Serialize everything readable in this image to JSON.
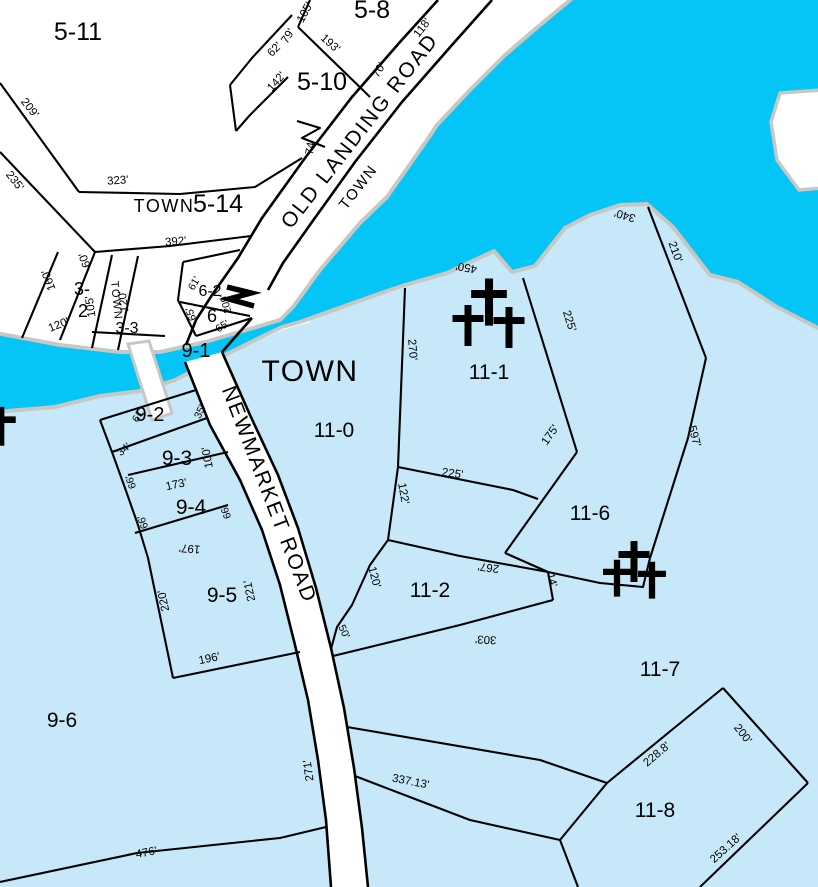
{
  "map": {
    "title": "Municipal tax parcel map",
    "colors": {
      "water": "#04C5F5",
      "land": "#C6E8F8",
      "outside": "#FFFFFF",
      "shore": "#C7C7C4",
      "road": "#FFFFFF",
      "line": "#000000"
    },
    "parcel_labels": [
      [
        "5-11",
        78,
        40,
        25,
        0
      ],
      [
        "5-8",
        372,
        18,
        25,
        0
      ],
      [
        "5-10",
        322,
        90,
        25,
        0
      ],
      [
        "5-14",
        218,
        212,
        25,
        0
      ],
      [
        "TOWN",
        164,
        212,
        18,
        0
      ],
      [
        "TOWN",
        310,
        381,
        30,
        0
      ],
      [
        "TOWN",
        362,
        190,
        15,
        -52
      ],
      [
        "TOWN",
        113,
        301,
        11,
        84
      ],
      [
        "3-",
        82,
        295,
        18,
        0
      ],
      [
        "2",
        83,
        317,
        18,
        0
      ],
      [
        "3-3",
        127,
        333,
        16,
        0
      ],
      [
        "6-2",
        210,
        296,
        16,
        0
      ],
      [
        "6",
        212,
        322,
        18,
        0
      ],
      [
        "9-1",
        196,
        357,
        20,
        0
      ],
      [
        "9-2",
        150,
        421,
        20,
        0
      ],
      [
        "9-3",
        177,
        465,
        21,
        0
      ],
      [
        "9-4",
        191,
        514,
        21,
        0
      ],
      [
        "9-5",
        222,
        602,
        21,
        0
      ],
      [
        "9-6",
        62,
        727,
        21,
        0
      ],
      [
        "11-0",
        334,
        437,
        21,
        0
      ],
      [
        "11-1",
        489,
        379,
        21,
        0
      ],
      [
        "11-2",
        430,
        597,
        21,
        0
      ],
      [
        "11-6",
        590,
        520,
        21,
        0
      ],
      [
        "11-7",
        660,
        676,
        21,
        0
      ],
      [
        "11-8",
        655,
        817,
        21,
        0
      ]
    ],
    "road_labels": [
      [
        "OLD LANDING ROAD",
        365,
        135,
        -52,
        21,
        2
      ],
      [
        "NEWMARKET ROAD",
        263,
        497,
        69,
        21,
        2
      ]
    ],
    "measurements": [
      [
        "209'",
        27,
        110,
        52,
        11.5
      ],
      [
        "235'",
        12,
        183,
        52,
        11.5
      ],
      [
        "323'",
        118,
        184,
        -4,
        11.5
      ],
      [
        "392'",
        176,
        245,
        -5,
        11.5
      ],
      [
        "160'",
        52,
        279,
        250,
        11.5
      ],
      [
        "60'",
        88,
        259,
        250,
        11.5
      ],
      [
        "105'",
        94,
        306,
        262,
        11.5
      ],
      [
        "120'",
        127,
        301,
        262,
        11.5
      ],
      [
        "120'",
        60,
        328,
        -22,
        11.5
      ],
      [
        "105'",
        308,
        14,
        -62,
        11.5
      ],
      [
        "79'",
        291,
        38,
        -58,
        11.5
      ],
      [
        "62'",
        277,
        52,
        -45,
        11.5
      ],
      [
        "142'",
        279,
        84,
        -48,
        11.5
      ],
      [
        "193'",
        328,
        46,
        42,
        11.5
      ],
      [
        "70'",
        382,
        72,
        -58,
        11.5
      ],
      [
        "118'",
        425,
        30,
        -52,
        11.5
      ],
      [
        "74'",
        314,
        148,
        -80,
        11.5
      ],
      [
        "61'",
        197,
        285,
        -60,
        10.5
      ],
      [
        "65'",
        194,
        313,
        250,
        10.5
      ],
      [
        "65'",
        224,
        329,
        -32,
        10.5
      ],
      [
        "209'",
        229,
        303,
        255,
        10.5
      ],
      [
        "450'",
        467,
        264,
        190,
        11.5
      ],
      [
        "340'",
        626,
        212,
        197,
        11.5
      ],
      [
        "210'",
        672,
        253,
        70,
        11.5
      ],
      [
        "597'",
        691,
        437,
        75,
        11.5
      ],
      [
        "270'",
        409,
        350,
        85,
        11.5
      ],
      [
        "225'",
        566,
        322,
        72,
        11.5
      ],
      [
        "175'",
        553,
        437,
        -55,
        11.5
      ],
      [
        "225'",
        452,
        477,
        8,
        11.5
      ],
      [
        "122'",
        400,
        494,
        80,
        11.5
      ],
      [
        "267'",
        489,
        564,
        188,
        11.5
      ],
      [
        "14'",
        549,
        581,
        75,
        10.5
      ],
      [
        "120'",
        371,
        578,
        75,
        11.5
      ],
      [
        "50'",
        341,
        633,
        65,
        10.5
      ],
      [
        "303'",
        486,
        636,
        183,
        11.5
      ],
      [
        "35'",
        203,
        413,
        -65,
        10.5
      ],
      [
        "61'",
        141,
        417,
        -60,
        10.5
      ],
      [
        "34'",
        126,
        452,
        -40,
        10.5
      ],
      [
        "66'",
        134,
        481,
        250,
        10.5
      ],
      [
        "66'",
        146,
        521,
        250,
        10.5
      ],
      [
        "66'",
        229,
        511,
        250,
        10.5
      ],
      [
        "100'",
        211,
        457,
        260,
        11.5
      ],
      [
        "173'",
        177,
        488,
        -12,
        11.5
      ],
      [
        "197'",
        190,
        545,
        185,
        11.5
      ],
      [
        "220'",
        167,
        600,
        258,
        11.5
      ],
      [
        "221'",
        253,
        590,
        258,
        11.5
      ],
      [
        "196'",
        210,
        662,
        -12,
        11.5
      ],
      [
        "271'",
        312,
        770,
        262,
        11.5
      ],
      [
        "337.13'",
        410,
        785,
        11,
        11.5
      ],
      [
        "476'",
        147,
        856,
        -11,
        11.5
      ],
      [
        "228.8'",
        659,
        757,
        -40,
        11.5
      ],
      [
        "200'",
        740,
        736,
        52,
        11.5
      ],
      [
        "253.18'",
        728,
        851,
        -42,
        11.5
      ]
    ],
    "crosses": [
      [
        489,
        298,
        1.15
      ],
      [
        468,
        322,
        1
      ],
      [
        509,
        324,
        1
      ],
      [
        634,
        558,
        1
      ],
      [
        617,
        575,
        0.9
      ],
      [
        652,
        577,
        0.9
      ],
      [
        1,
        423,
        0.95
      ]
    ],
    "cross_path": "M-3.5,-17 h7 v10 h12 v7 h-12 v24 h-7 v-24 h-12 v-7 h12 Z",
    "stream_symbol": "M227,287 L251,293 L229,299 L254,306",
    "geometry": {
      "outside_region": "-4,-4 575,-4 575,0 540,25 505,55 470,90 437,125 427,140 387,197 360,223 320,270 293,307 280,320 243,331 205,342 160,352 120,352 60,345 -4,333",
      "junction": "186,315 196,295 268,288 310,305 310,322 282,330 255,342 235,352 210,364 196,378 185,362",
      "water": "575,-4 822,-4 822,330 777,307 738,282 710,275 673,227 647,204 620,205 590,215 565,228 535,266 512,272 494,251 447,273 405,285 387,291 300,322 282,327 255,340 235,350 210,362 175,380 140,391 100,396 55,407 -4,412 -4,333 60,345 120,352 160,352 205,342 243,331 280,320 293,307 320,270 360,223 387,197 427,140 437,125 470,90 505,55 540,25",
      "landmass": "780,93 822,90 822,188 799,190 777,160 771,122",
      "crossing": "128,344 149,341 172,413 152,420",
      "roads": {
        "old_landing": {
          "west": "438,0 400,42 352,97 305,158 262,218 238,258 212,295",
          "east": "492,0 452,45 402,102 355,162 312,222 283,263 268,290"
        },
        "newmarket": {
          "west": "185,362 210,425 240,480 262,530 280,585 295,645 308,700 318,760 326,820 331,887",
          "east": "222,352 250,415 278,475 298,528 316,588 331,648 344,708 354,768 362,828 368,887"
        }
      },
      "connectors": [
        "212,295 196,320 186,345",
        "252,318 222,352"
      ],
      "boundaries": [
        "0,83 79,192",
        "0,152 95,252",
        "79,192 180,194 255,187 302,158",
        "95,252 170,246 251,236",
        "58,252 22,338",
        "95,252 60,340",
        "112,255 92,348",
        "138,256 118,350",
        "92,332 165,336",
        "183,262 178,300 196,336",
        "183,262 240,250",
        "180,302 250,316",
        "196,336 252,318",
        "310,0 298,27",
        "298,27 370,97",
        "292,15 252,58 230,85",
        "288,77 250,115 236,131",
        "230,85 236,131",
        "297,121 320,128 302,138 325,147",
        "405,288 398,467",
        "523,278 577,452",
        "577,452 505,553",
        "398,467 513,490 538,499",
        "398,467 388,540",
        "388,540 370,565 352,605 337,627 331,649",
        "388,540 460,556 548,572",
        "548,572 553,600",
        "553,600 460,625 333,656",
        "505,553 548,572",
        "548,572 600,583 643,587 650,558",
        "650,558 688,438 706,358",
        "706,358 648,207",
        "347,727 540,760 607,783",
        "607,783 723,688",
        "723,688 808,783",
        "808,783 700,887",
        "607,783 560,840 578,887",
        "355,776 470,820 560,840",
        "0,882 137,853 280,838 326,827",
        "100,420 196,390",
        "100,420 112,452 125,488 138,525 148,558 173,678",
        "112,452 207,418",
        "128,475 228,452",
        "135,533 228,505",
        "173,678 300,652"
      ]
    }
  }
}
